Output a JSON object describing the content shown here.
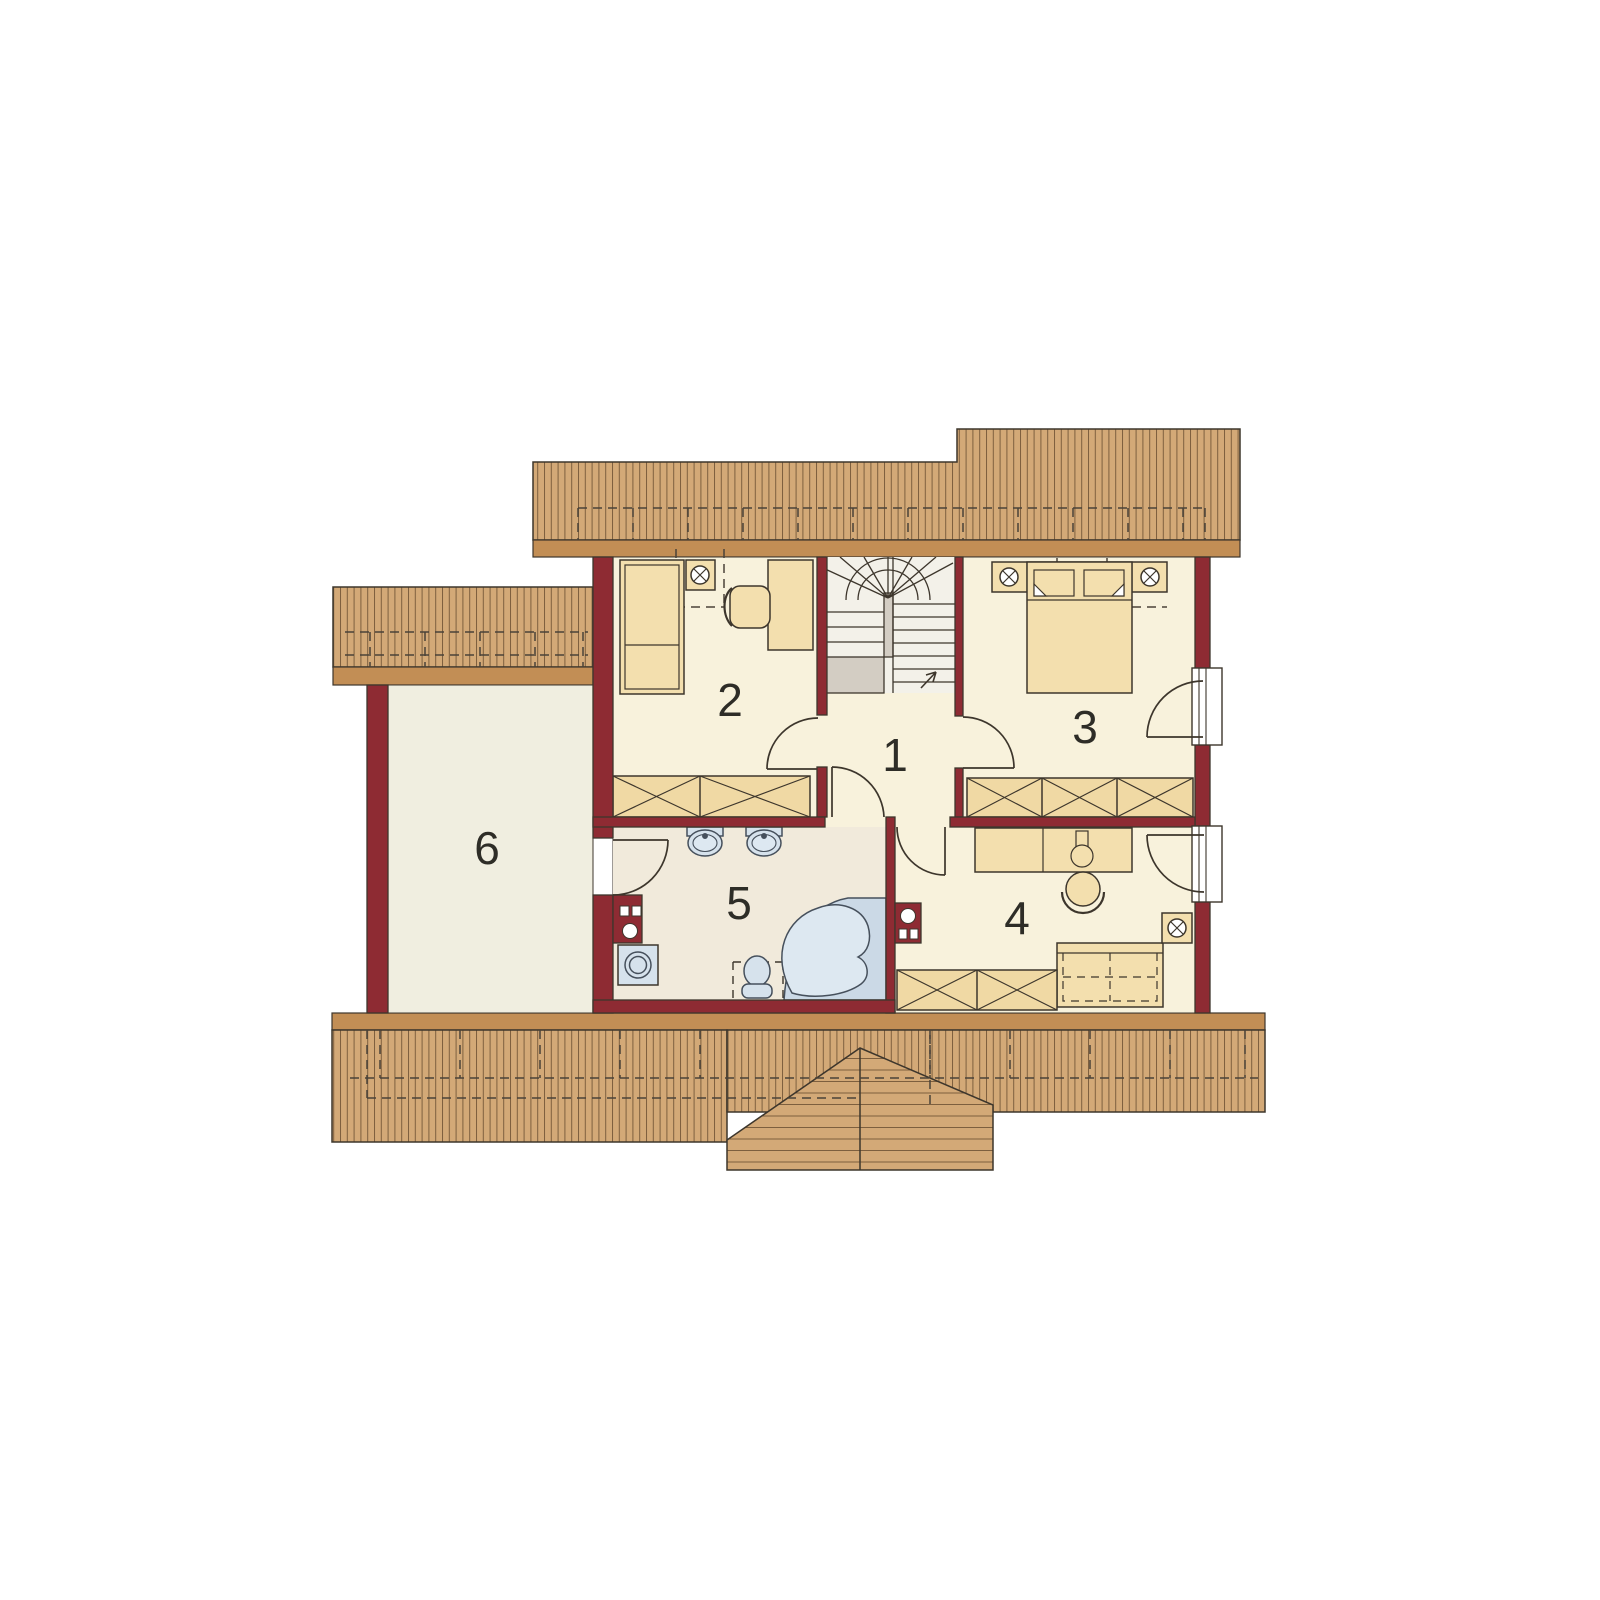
{
  "plan": {
    "kind": "attic floor plan",
    "rooms": [
      {
        "id": "room-1",
        "label": "1"
      },
      {
        "id": "room-2",
        "label": "2"
      },
      {
        "id": "room-3",
        "label": "3"
      },
      {
        "id": "room-4",
        "label": "4"
      },
      {
        "id": "room-5",
        "label": "5"
      },
      {
        "id": "room-6",
        "label": "6"
      }
    ],
    "features": {
      "room-1": [
        "staircase",
        "doors to rooms"
      ],
      "room-2": [
        "single-bed",
        "nightstand-lamp",
        "desk",
        "chair",
        "wardrobe"
      ],
      "room-3": [
        "double-bed",
        "two-nightstand-lamps",
        "wardrobe",
        "balcony-door"
      ],
      "room-4": [
        "desk",
        "chair",
        "sofa-bed",
        "nightstand-lamp",
        "wardrobe",
        "balcony-door",
        "chimney"
      ],
      "room-5": [
        "two-washbasins",
        "toilet",
        "corner-bathtub",
        "washing-machine",
        "chimney"
      ],
      "room-6": []
    },
    "symbols": {
      "ceiling-lamp": "circle-with-x",
      "wardrobe": "box-with-x",
      "stair-direction": "arrow"
    }
  },
  "colors": {
    "background": "#ffffff",
    "wall": "#8E2B33",
    "roof_field": "#D3A977",
    "roof_stripe": "#7d5f3e",
    "roof_fascia": "#C28E55",
    "floor_room": "#F8F2DC",
    "floor_bath": "#F1EADB",
    "floor_room6": "#F0EEE0",
    "floor_stairs": "#F3F1E9",
    "stair_landing": "#D3CDC3",
    "furniture": "#F3DFAE",
    "closet": "#F0D9A4",
    "fixture_blue": "#D6E2EC",
    "fixture_inner": "#DDE8F1",
    "outline": "#3d362c",
    "label_text": "#2e2d27"
  }
}
